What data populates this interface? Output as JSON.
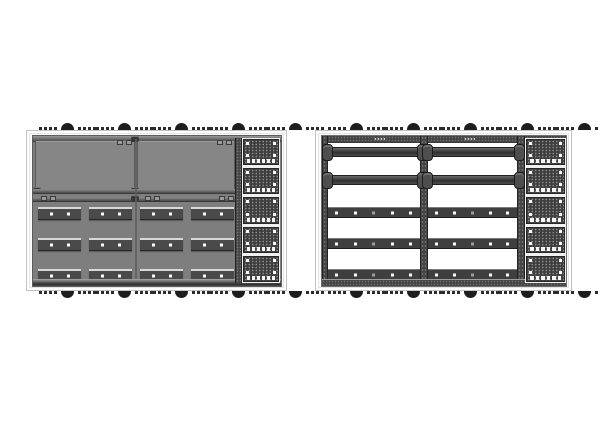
{
  "scene": {
    "description": "Two technical renders of a modular display cabinet: left unit shown with solid rear cover panels, right unit shown as open bare frame",
    "background": "#ffffff"
  },
  "colors": {
    "page-bg": "#ffffff",
    "shell-bg": "#fbfbfb",
    "shell-border": "#c2c2c2",
    "solid-fill": "#7e7e7e",
    "panel-fill": "#868686",
    "panel-border": "#5a5a5a",
    "frame-dark": "#454545",
    "rail-dark": "#3f3f3f",
    "bar-fill": "#4a4a4a",
    "edge-light": "#d8d8d8",
    "darkest": "#1f1f1f",
    "foot": "#1d1d1d",
    "foot-sq": "#2b2b2b",
    "vent-fill": "#3e3e3e",
    "vent-dot": "#8f8f8f",
    "white-dot": "#fafafa"
  },
  "left_assembly": {
    "variant": "solid-covered",
    "feet_clusters_top": 5,
    "feet_clusters_bottom": 5,
    "foot_squares_per_side": 4,
    "cover_panels": 2,
    "bar_rows": 3,
    "bars_per_row": 4,
    "dots_per_bar": 2,
    "vent_blocks": 5,
    "tabs_per_block": 6,
    "corner_dots_per_block": 4
  },
  "right_assembly": {
    "variant": "open-frame",
    "feet_clusters_top": 5,
    "feet_clusters_bottom": 5,
    "foot_squares_per_side": 4,
    "columns": 2,
    "thick_rails_per_column": 2,
    "thin_rails_per_column": 3,
    "dots_per_thin_rail": 5,
    "vent_blocks": 5,
    "tabs_per_block": 6,
    "corner_dots_per_block": 4
  }
}
